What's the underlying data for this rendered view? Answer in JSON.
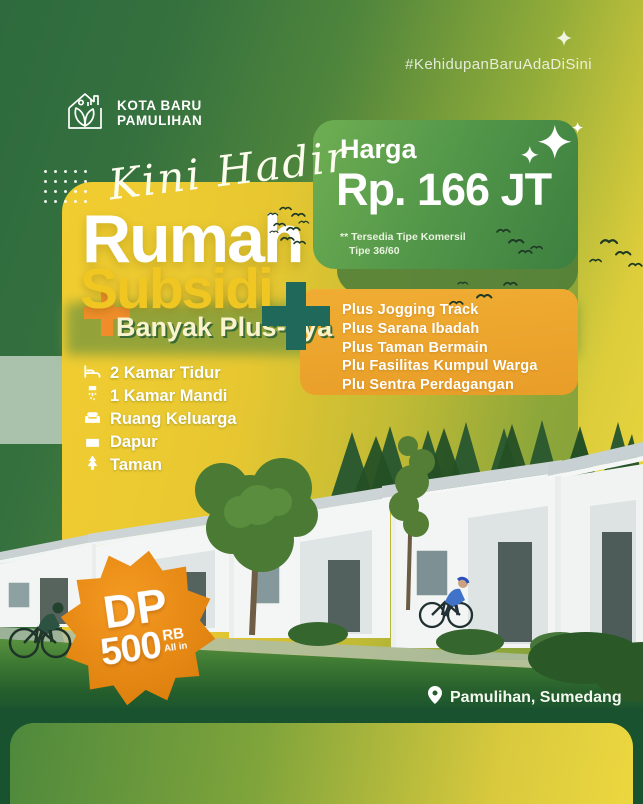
{
  "colors": {
    "bg_dark_green": "#2d6a3d",
    "bg_yellow": "#f0da3e",
    "card_yellow": "#f2cd31",
    "price_card_green": "#4c9144",
    "plus_card_orange": "#eda42d",
    "accent_orange": "#f08d2a",
    "accent_teal": "#20695a",
    "badge_orange": "#e0820f",
    "title_white": "#ffffff",
    "title_yellow": "#f0c722",
    "footer_green": "#19522f"
  },
  "header": {
    "hashtag": "#KehidupanBaruAdaDiSini",
    "logo_line1": "KOTA BARU",
    "logo_line2": "PAMULIHAN"
  },
  "hero": {
    "script_text": "Kini Hadir",
    "title_line1": "Rumah",
    "title_line2": "Subsidi",
    "subtitle": "Banyak Plus-nya"
  },
  "price_card": {
    "label": "Harga",
    "value": "Rp. 166 JT",
    "note_line1": "** Tersedia Tipe Komersil",
    "note_line2": "Tipe 36/60"
  },
  "plus_card": {
    "items": [
      "Plus Jogging Track",
      "Plus Sarana Ibadah",
      "Plus Taman Bermain",
      "Plu Fasilitas Kumpul Warga",
      "Plu Sentra Perdagangan"
    ]
  },
  "features": {
    "items": [
      {
        "icon": "bed-icon",
        "label": "2 Kamar Tidur"
      },
      {
        "icon": "shower-icon",
        "label": "1 Kamar Mandi"
      },
      {
        "icon": "sofa-icon",
        "label": "Ruang Keluarga"
      },
      {
        "icon": "kitchen-icon",
        "label": "Dapur"
      },
      {
        "icon": "tree-icon",
        "label": "Taman"
      }
    ]
  },
  "dp_badge": {
    "prefix": "DP",
    "amount": "500",
    "unit": "RB",
    "note": "All in"
  },
  "footer": {
    "location": "Pamulihan, Sumedang"
  }
}
